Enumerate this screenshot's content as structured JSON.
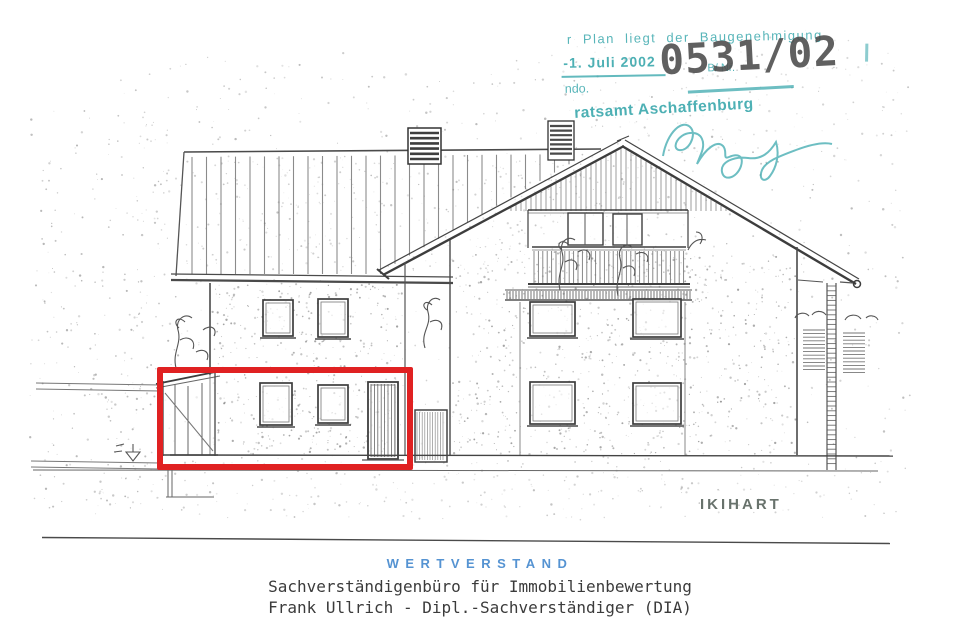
{
  "stamp": {
    "approval_line": "r Plan liegt der Baugenehmigung",
    "date": "-1. Juli 2002",
    "reference": "B/ Nr.",
    "file_number": "0531/02",
    "fragment": "ndo.",
    "authority": "ratsamt Aschaffenburg",
    "ink_color": "#2fa3a8",
    "number_color": "#4b4b4b"
  },
  "drawing": {
    "architect_label": "IKIHART",
    "highlight_color": "#e02122"
  },
  "footer": {
    "brand": "WERTVERSTAND",
    "brand_color": "#5593d2",
    "office_line": "Sachverständigenbüro für Immobilienbewertung",
    "name_line": "Frank Ullrich - Dipl.-Sachverständiger (DIA)"
  }
}
